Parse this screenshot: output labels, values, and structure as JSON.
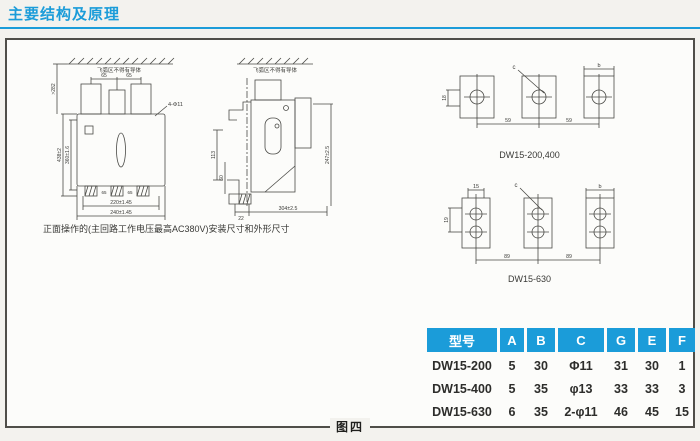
{
  "page": {
    "title": "主要结构及原理",
    "figure_label": "图四"
  },
  "front_view": {
    "note": "飞弧区不得有导体",
    "caption": "正面操作的(主回路工作电压最高AC380V)安装尺寸和外形尺寸",
    "dims": {
      "clearance": ">282",
      "pitch_left": "65",
      "pitch_right": "65",
      "holes": "4-Φ11",
      "height": "438±2",
      "mount_height": "360±1.6",
      "foot_left": "65",
      "foot_right": "65",
      "mount_width": "220±1.45",
      "width": "240±1.45"
    }
  },
  "side_view": {
    "note": "飞弧区不得有导体",
    "dims": {
      "d113": "113",
      "d60": "60",
      "d22": "22",
      "depth": "304±2.5",
      "height": "247±2.5"
    }
  },
  "terminals_small": {
    "caption": "DW15-200,400",
    "dims": {
      "c": "c",
      "b": "b",
      "w18": "18",
      "pitch1": "59",
      "pitch2": "59"
    }
  },
  "terminals_large": {
    "caption": "DW15-630",
    "dims": {
      "t15": "15",
      "c": "c",
      "b": "b",
      "w19": "19",
      "pitch1": "89",
      "pitch2": "89"
    }
  },
  "spec_table": {
    "headers": [
      "型号",
      "A",
      "B",
      "C",
      "G",
      "E",
      "F"
    ],
    "rows": [
      [
        "DW15-200",
        "5",
        "30",
        "Φ11",
        "31",
        "30",
        "1"
      ],
      [
        "DW15-400",
        "5",
        "35",
        "φ13",
        "33",
        "33",
        "3"
      ],
      [
        "DW15-630",
        "6",
        "35",
        "2-φ11",
        "46",
        "45",
        "15"
      ]
    ]
  },
  "colors": {
    "accent": "#1b9cd9",
    "page_background": "#f3f2ee",
    "box_background": "#fcfcfa"
  }
}
